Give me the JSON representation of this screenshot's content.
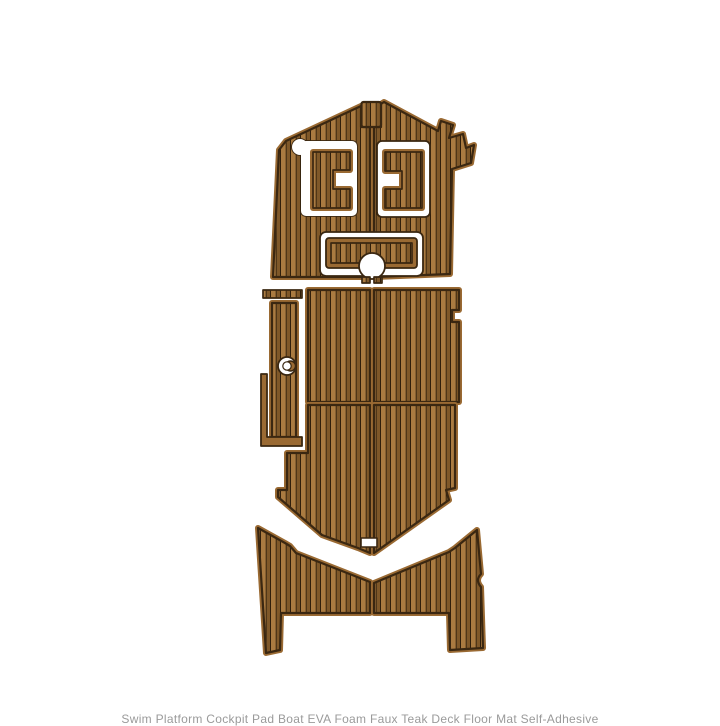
{
  "page": {
    "background": "#ffffff"
  },
  "caption": {
    "text": "Swim Platform Cockpit Pad Boat EVA Foam Faux Teak Deck Floor Mat Self-Adhesive"
  },
  "colors": {
    "plank_light": "#aa7b41",
    "plank_dark": "#7f5829",
    "plank_seam": "#2f1e0b",
    "pad_edge": "#9a6a33",
    "outline": "#3a2711",
    "background": "#ffffff",
    "caption": "#9a9a9a"
  },
  "illustration": {
    "subject": "boat-eva-foam-teak-decking-pad-set",
    "parts": [
      {
        "label": "bow pad left half"
      },
      {
        "label": "bow pad right half"
      },
      {
        "label": "bow top tab pad"
      },
      {
        "label": "helm cutout left"
      },
      {
        "label": "helm insert pad left"
      },
      {
        "label": "helm cutout right"
      },
      {
        "label": "helm insert pad right"
      },
      {
        "label": "hatch cutout"
      },
      {
        "label": "hatch pad"
      },
      {
        "label": "hatch drain hole"
      },
      {
        "label": "side trim strip"
      },
      {
        "label": "side panel pad"
      },
      {
        "label": "side panel cap hole"
      },
      {
        "label": "l-shaped trim pad"
      },
      {
        "label": "cockpit floor front left"
      },
      {
        "label": "cockpit floor front right"
      },
      {
        "label": "cockpit floor rear left"
      },
      {
        "label": "cockpit floor rear right"
      },
      {
        "label": "transom notch"
      },
      {
        "label": "swim platform pad left"
      },
      {
        "label": "swim platform pad right"
      }
    ]
  }
}
